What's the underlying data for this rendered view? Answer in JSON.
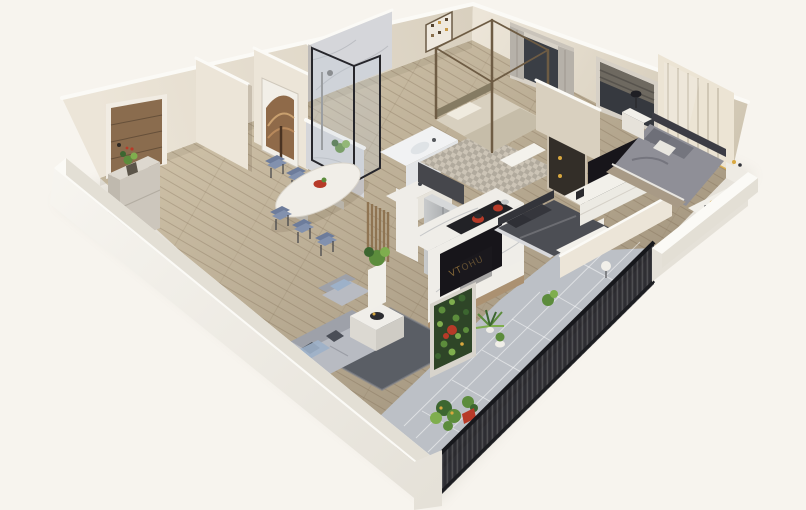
{
  "scene": {
    "kind": "3d-isometric-cutaway-floorplan-render",
    "background": "plain cream backdrop, no text or UI",
    "tv": {
      "screen_logo": "VTOHU"
    },
    "rooms": [
      {
        "name": "entry-hall",
        "items": [
          "wood-entrance-door",
          "console-table",
          "potted-plant"
        ]
      },
      {
        "name": "dining-area",
        "items": [
          "oval-marble-table",
          "red-fruit-bowl",
          "blue-chairs-x6",
          "arched-wall-artwork",
          "wood-slat-divider"
        ]
      },
      {
        "name": "bathroom",
        "items": [
          "marble-walls",
          "black-frame-glass-shower",
          "white-vanity-bathtub",
          "ledge-plant"
        ]
      },
      {
        "name": "kitchen",
        "items": [
          "stainless-refrigerator",
          "dark-upper-cabinet",
          "marble-island",
          "black-cooktop",
          "red-cookware",
          "oven",
          "sink-counter"
        ]
      },
      {
        "name": "living-room",
        "items": [
          "gray-sofa",
          "lounge-chair",
          "marble-cube-coffee-table",
          "dark-gray-rug",
          "marble-tv-wall",
          "tv-console",
          "pedestal-plant"
        ]
      },
      {
        "name": "canopy-bedroom",
        "items": [
          "four-poster-bed",
          "checkered-rug",
          "small-wall-art",
          "lit-display-cabinet",
          "window-gray-curtains",
          "white-bench"
        ]
      },
      {
        "name": "middle-bedroom",
        "items": [
          "dark-gray-bed",
          "white-foot-bench"
        ]
      },
      {
        "name": "master-bedroom",
        "items": [
          "gray-double-bed",
          "nightstands-with-lamps",
          "tv-stand-with-tv",
          "cream-sliding-wardrobe",
          "window-roman-shade",
          "bench-with-yellow-accents"
        ]
      },
      {
        "name": "hall-bathroom",
        "items": [
          "white-fixture",
          "potted-plant"
        ]
      },
      {
        "name": "balcony",
        "items": [
          "black-iron-railing",
          "marble-tile-floor",
          "vertical-garden-panel",
          "fern",
          "plant-cluster",
          "red-pot",
          "globe-floor-lamp"
        ]
      }
    ]
  },
  "palette": {
    "bg": "#f7f4ee",
    "wall_cream_1": "#ece5d8",
    "wall_cream_2": "#d9d0bf",
    "wall_cream_3": "#cfc5b1",
    "wall_top": "#fbfaf6",
    "wall_inner": "#e3dfd5",
    "band_1": "#f7f5f0",
    "band_2": "#e5e1d8",
    "floor_wood_1": "#d6c9af",
    "floor_wood_2": "#a2947d",
    "plank_line": "rgba(110,90,66,0.30)",
    "door_wood": "#8a6c4e",
    "door_wood_dark": "#66503a",
    "marble_light": "#d5d6da",
    "marble_white": "#efede8",
    "marble_vein": "#a6a9af",
    "glass_tint": "rgba(195,205,215,0.30)",
    "frame_dark": "#26262b",
    "steel_1": "#c9cbcc",
    "steel_2": "#94979a",
    "counter_dark": "#222226",
    "pot_red": "#bf3a2c",
    "tv_black": "#17151a",
    "gold": "#c89a4a",
    "sofa_gray": "#b8bbc2",
    "sofa_gray_dark": "#9ea1a9",
    "pillow_dark": "#40444c",
    "throw_blue": "#9db1c9",
    "rug_dark": "#5a5e65",
    "rug_border": "#82868d",
    "chair_blue": "#8291ae",
    "chair_blue_dark": "#6d7c9b",
    "table_white": "#f1eee8",
    "bed_beige": "#d8d0bf",
    "post_brown": "#6e5c44",
    "bedding_gray": "#8f8f97",
    "bedding_dark": "#4c4e54",
    "tan_blanket": "#a89a86",
    "wardrobe_cream": "#ece4d4",
    "wardrobe_line": "#c6bcaa",
    "rail_dark": "#26272c",
    "tile_gray": "#bcc0c6",
    "tile_line": "rgba(255,255,255,0.5)",
    "slat_wood": "#8f7452",
    "green_1": "#3c6630",
    "green_2": "#5c8c3c",
    "green_3": "#7fae4e",
    "green_dark": "#2e4527",
    "flower_red": "#b73a28",
    "accent_yellow": "#d9a83f"
  }
}
